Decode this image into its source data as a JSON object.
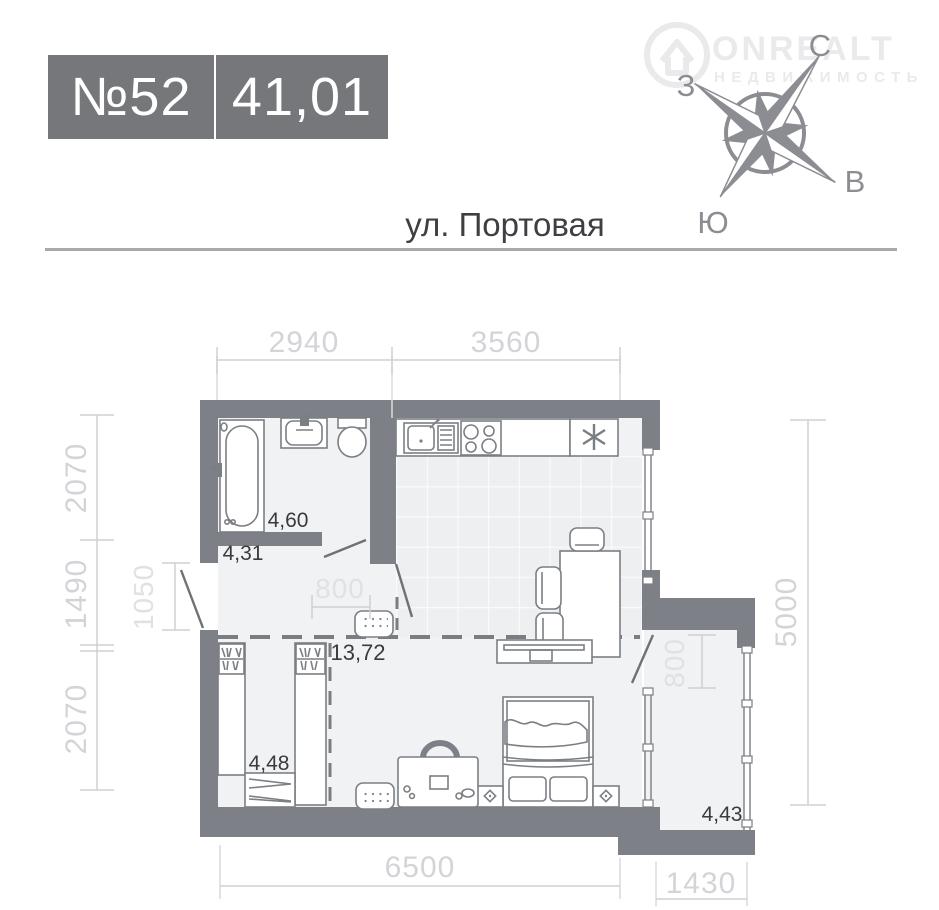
{
  "header": {
    "unit_label": "№52",
    "area_value": "41,01"
  },
  "address": {
    "street": "ул. Портовая"
  },
  "watermark": {
    "brand": "ONREALT",
    "tagline": "НЕДВИЖИМОСТЬ"
  },
  "compass": {
    "north": "С",
    "west": "З",
    "east": "В",
    "south": "Ю"
  },
  "rooms": {
    "bathroom_area": "4,60",
    "hallway_area": "4,31",
    "living_kitchen_area": "13,72",
    "wardrobe_area": "4,48",
    "balcony_area": "4,43"
  },
  "dimensions_mm": {
    "top_left": "2940",
    "top_right": "3560",
    "left_top": "2070",
    "left_middle": "1490",
    "left_bottom": "2070",
    "entry_opening": "1050",
    "hall_opening": "800",
    "right_height": "5000",
    "balcony_door_opening": "800",
    "bottom_width": "6500",
    "balcony_width": "1430"
  },
  "colors": {
    "wall": "#7d8086",
    "badge": "#76777b",
    "floor": "#f1f2f3",
    "dimension_text": "#d2d4d7",
    "area_text": "#3a3b3d"
  }
}
